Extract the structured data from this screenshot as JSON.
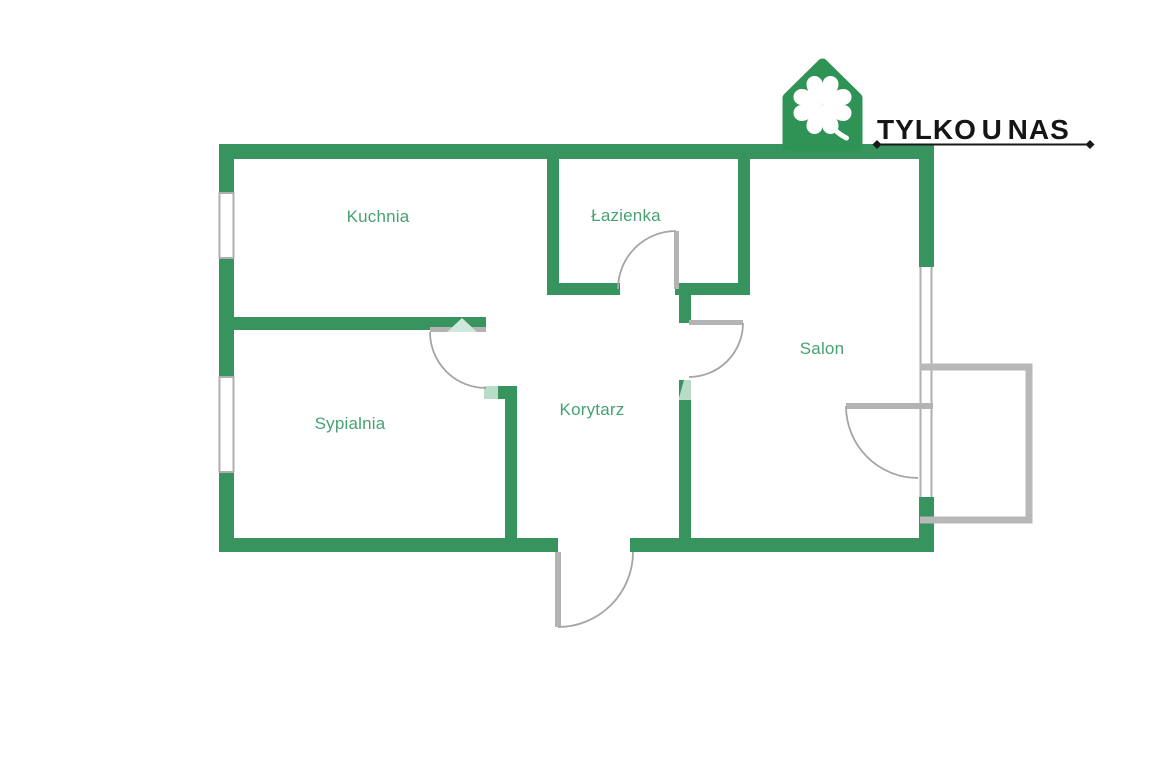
{
  "page": {
    "background": "#FFFFFF"
  },
  "logo": {
    "brand_text": "TYLKO U NAS",
    "icon": "house-clover-icon",
    "house_color": "#2F9355",
    "clover_color": "#FFFFFF",
    "text_color": "#151515"
  },
  "floor_plan": {
    "wall_color": "#38945F",
    "label_color": "#47A273",
    "door_color": "#B3B3B3",
    "door_arc_color": "#A5A5A5",
    "door_accent_color": "#CFE8DC",
    "balcony_color": "#B8B8B8",
    "rooms": [
      {
        "name": "kuchnia",
        "label": "Kuchnia"
      },
      {
        "name": "lazienka",
        "label": "Łazienka"
      },
      {
        "name": "salon",
        "label": "Salon"
      },
      {
        "name": "sypialnia",
        "label": "Sypialnia"
      },
      {
        "name": "korytarz",
        "label": "Korytarz"
      }
    ],
    "features": {
      "windows": 3,
      "doors": 5,
      "balcony": true,
      "entrance_side": "bottom"
    }
  }
}
